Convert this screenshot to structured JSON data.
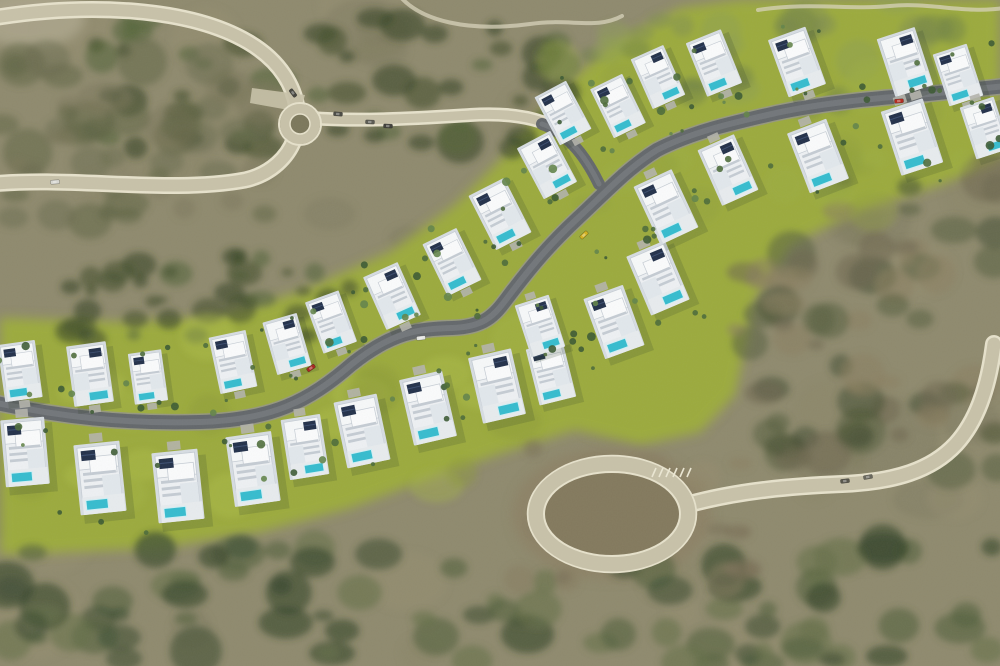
{
  "scene": {
    "description": "Aerial 3D render of a hillside residential development: two rows of white modern villas with rooftop solar panels and turquoise pools along a winding dark asphalt road, set in olive scrubland with a small roundabout at upper left and a large sandy cul-de-sac circle at lower right",
    "width": 1000,
    "height": 666
  },
  "palette": {
    "base": "#8f8a6e",
    "grass": "#9cab3d",
    "sand": "#c8c2a9",
    "sand_edge": "#e7e2cc",
    "asphalt": "#63676b",
    "asphalt_center": "#767a7e",
    "asphalt_shoulder": "#94948a",
    "villa_plot": "#d7dde3",
    "villa_body": "#eef1f4",
    "villa_roof": "#f7f9fa",
    "villa_line": "#c6cdd5",
    "villa_slat": "#c5ccd4",
    "villa_wing": "#e2e8ed",
    "solar": "#22304a",
    "solar_line": "#3a4c6e",
    "pool": "#35bccf",
    "pool_edge": "#d2f0f6",
    "deck": "#e8ecef",
    "driveway": "#b4b4ac",
    "shadow": "#2f3d28",
    "dirt_center": "#83795d"
  },
  "roads": {
    "asphalt_main": "M -8 402 C 60 417 125 424 200 422 C 272 420 308 402 352 364 C 392 332 418 329 452 328 C 484 327 494 316 508 297 C 530 268 548 246 578 218 C 608 190 628 168 657 150 C 692 132 732 123 776 113 C 828 102 880 98 928 94 L 1006 86",
    "asphalt_link": "M 542 124 C 566 132 585 155 599 184",
    "sand_top": "M -8 18 C 90 2 190 8 248 42 C 282 62 294 88 297 108",
    "sand_left": "M -8 184 C 70 176 170 194 245 180 C 272 174 288 156 294 140",
    "sand_link": "M 311 118 C 360 122 420 118 470 115 C 500 113 525 116 542 122",
    "circle_east": "M 686 505 C 740 490 795 486 842 484 C 895 482 932 470 956 444 C 976 422 988 390 994 344",
    "trail_mid": "M 398 -6 C 420 22 470 32 530 24 C 570 18 596 30 622 16",
    "trail_topright": "M 758 10 C 810 2 848 10 890 6 C 930 2 965 14 1004 8",
    "roundabout": {
      "cx": 300,
      "cy": 124,
      "r": 15
    },
    "cul_de_sac": {
      "cx": 612,
      "cy": 514,
      "rx": 76,
      "ry": 50
    },
    "parking_pad": "M 252 88 L 305 95 L 300 112 L 250 103 Z",
    "hatch": {
      "x": 652,
      "y": 474,
      "n": 6,
      "dx": 7
    }
  },
  "terrain": {
    "grass_poly": "M 0 318 L 120 322 L 210 318 L 300 292 L 390 252 L 455 205 L 505 155 L 555 95 L 610 45 L 680 8 L 740 0 L 1000 0 L 1000 160 L 940 185 L 860 210 L 790 245 L 755 300 L 735 395 L 700 432 L 640 445 L 575 430 L 505 452 L 430 478 L 350 508 L 260 532 L 160 548 L 0 555 Z",
    "patches": [
      {
        "cx": 612,
        "cy": 514,
        "rx": 100,
        "ry": 66,
        "fill": "#8d8266",
        "op": 0.9
      },
      {
        "cx": 30,
        "cy": 18,
        "rx": 55,
        "ry": 30,
        "fill": "#b2ac93",
        "op": 0.7
      }
    ],
    "zones": [
      {
        "rect": [
          0,
          0,
          1000,
          666
        ],
        "n": 55,
        "rad": [
          18,
          55
        ],
        "colors": [
          "#8a8569",
          "#958f72",
          "#7e7a60"
        ],
        "op": 0.4,
        "pregrass": true
      },
      {
        "rect": [
          95,
          15,
          475,
          135
        ],
        "n": 55,
        "rad": [
          7,
          24
        ],
        "colors": [
          "#42502f",
          "#384628",
          "#55663a"
        ],
        "op": 0.6
      },
      {
        "rect": [
          60,
          255,
          295,
          85
        ],
        "n": 40,
        "rad": [
          6,
          18
        ],
        "colors": [
          "#42502f",
          "#384628",
          "#55663a"
        ],
        "op": 0.6
      },
      {
        "rect": [
          0,
          55,
          265,
          170
        ],
        "n": 45,
        "rad": [
          9,
          28
        ],
        "colors": [
          "#6a6b4d",
          "#5b6142",
          "#7b775c"
        ],
        "op": 0.5
      },
      {
        "rect": [
          735,
          175,
          265,
          295
        ],
        "n": 70,
        "rad": [
          8,
          26
        ],
        "colors": [
          "#6e6850",
          "#565f3e",
          "#454e33",
          "#8a8061"
        ],
        "op": 0.55
      },
      {
        "rect": [
          0,
          546,
          1000,
          120
        ],
        "n": 85,
        "rad": [
          9,
          28
        ],
        "colors": [
          "#3f4e33",
          "#33422a",
          "#52603c",
          "#667049"
        ],
        "op": 0.6
      },
      {
        "rect": [
          515,
          448,
          235,
          135
        ],
        "n": 28,
        "rad": [
          8,
          20
        ],
        "colors": [
          "#877c60",
          "#968c6d",
          "#776e55"
        ],
        "op": 0.5
      },
      {
        "rect": [
          590,
          0,
          410,
          112
        ],
        "n": 30,
        "rad": [
          10,
          24
        ],
        "colors": [
          "#7e8c52",
          "#6d7e48",
          "#8fa054"
        ],
        "op": 0.45
      },
      {
        "rect": [
          0,
          330,
          560,
          205
        ],
        "n": 26,
        "rad": [
          12,
          30
        ],
        "colors": [
          "#b0bf4a",
          "#a4b545",
          "#8c9c38"
        ],
        "op": 0.4
      },
      {
        "rect": [
          540,
          55,
          460,
          165
        ],
        "n": 22,
        "rad": [
          10,
          26
        ],
        "colors": [
          "#9fb044",
          "#8fa03c"
        ],
        "op": 0.35
      }
    ]
  },
  "villas": [
    [
      20,
      371,
      0.9,
      -8,
      1,
      0
    ],
    [
      90,
      374,
      0.95,
      -8,
      1,
      1
    ],
    [
      148,
      377,
      0.8,
      -8,
      1,
      0
    ],
    [
      233,
      362,
      0.9,
      -12,
      1,
      0
    ],
    [
      287,
      344,
      0.85,
      -16,
      1,
      1
    ],
    [
      331,
      322,
      0.85,
      -20,
      1,
      0
    ],
    [
      392,
      296,
      0.9,
      -24,
      1,
      1
    ],
    [
      452,
      262,
      0.9,
      -26,
      1,
      0
    ],
    [
      500,
      214,
      0.95,
      -27,
      1,
      0
    ],
    [
      547,
      165,
      0.9,
      -28,
      1,
      1
    ],
    [
      563,
      113,
      0.85,
      -28,
      1,
      0
    ],
    [
      618,
      106,
      0.85,
      -26,
      1,
      0
    ],
    [
      658,
      77,
      0.85,
      -24,
      1,
      1
    ],
    [
      714,
      63,
      0.9,
      -22,
      1,
      0
    ],
    [
      797,
      62,
      0.95,
      -20,
      1,
      0
    ],
    [
      905,
      62,
      0.95,
      -18,
      1,
      1
    ],
    [
      958,
      75,
      0.85,
      -18,
      1,
      0
    ],
    [
      25,
      452,
      1.05,
      -5,
      -1,
      0
    ],
    [
      100,
      478,
      1.1,
      -6,
      -1,
      0
    ],
    [
      178,
      486,
      1.1,
      -6,
      -1,
      0
    ],
    [
      253,
      469,
      1.1,
      -8,
      -1,
      0
    ],
    [
      305,
      447,
      0.95,
      -9,
      -1,
      1
    ],
    [
      362,
      431,
      1.05,
      -12,
      -1,
      0
    ],
    [
      428,
      408,
      1.05,
      -13,
      -1,
      0
    ],
    [
      497,
      386,
      1.05,
      -13,
      -1,
      1
    ],
    [
      551,
      373,
      0.9,
      -14,
      -1,
      0
    ],
    [
      540,
      326,
      0.85,
      -18,
      -1,
      1
    ],
    [
      614,
      322,
      1.0,
      -20,
      -1,
      0
    ],
    [
      658,
      278,
      1.0,
      -23,
      -1,
      1
    ],
    [
      666,
      207,
      1.0,
      -25,
      -1,
      0
    ],
    [
      728,
      170,
      0.95,
      -24,
      -1,
      1
    ],
    [
      818,
      156,
      1.0,
      -21,
      -1,
      0
    ],
    [
      912,
      137,
      1.05,
      -18,
      -1,
      0
    ],
    [
      985,
      128,
      0.85,
      -18,
      -1,
      1
    ]
  ],
  "cars": [
    [
      311,
      368,
      -35,
      "#a8241f"
    ],
    [
      421,
      338,
      -6,
      "#e6e7e4"
    ],
    [
      584,
      235,
      -43,
      "#d4b31e"
    ],
    [
      899,
      101,
      -5,
      "#b3281e"
    ],
    [
      338,
      114,
      4,
      "#4a4a44"
    ],
    [
      370,
      122,
      3,
      "#5a5a52"
    ],
    [
      388,
      126,
      3,
      "#3f3f3a"
    ],
    [
      293,
      93,
      53,
      "#44443e"
    ],
    [
      845,
      481,
      -6,
      "#55544a"
    ],
    [
      868,
      477,
      -10,
      "#66655a"
    ],
    [
      55,
      182,
      -4,
      "#d8d8d2"
    ]
  ],
  "trees": {
    "seed": 73,
    "per_villa": 3,
    "palette": [
      "#3c5a33",
      "#4d6c3a",
      "#63844a"
    ],
    "anchors": [
      [
        70,
        393
      ],
      [
        150,
        407
      ],
      [
        225,
        404
      ],
      [
        298,
        384
      ],
      [
        358,
        348
      ],
      [
        415,
        320
      ],
      [
        468,
        310
      ],
      [
        505,
        255
      ],
      [
        558,
        205
      ],
      [
        612,
        158
      ],
      [
        672,
        130
      ],
      [
        735,
        110
      ],
      [
        795,
        98
      ],
      [
        858,
        92
      ],
      [
        928,
        85
      ],
      [
        480,
        345
      ],
      [
        545,
        300
      ],
      [
        600,
        250
      ],
      [
        655,
        235
      ],
      [
        700,
        195
      ]
    ]
  },
  "noise_opacity": 0.13
}
